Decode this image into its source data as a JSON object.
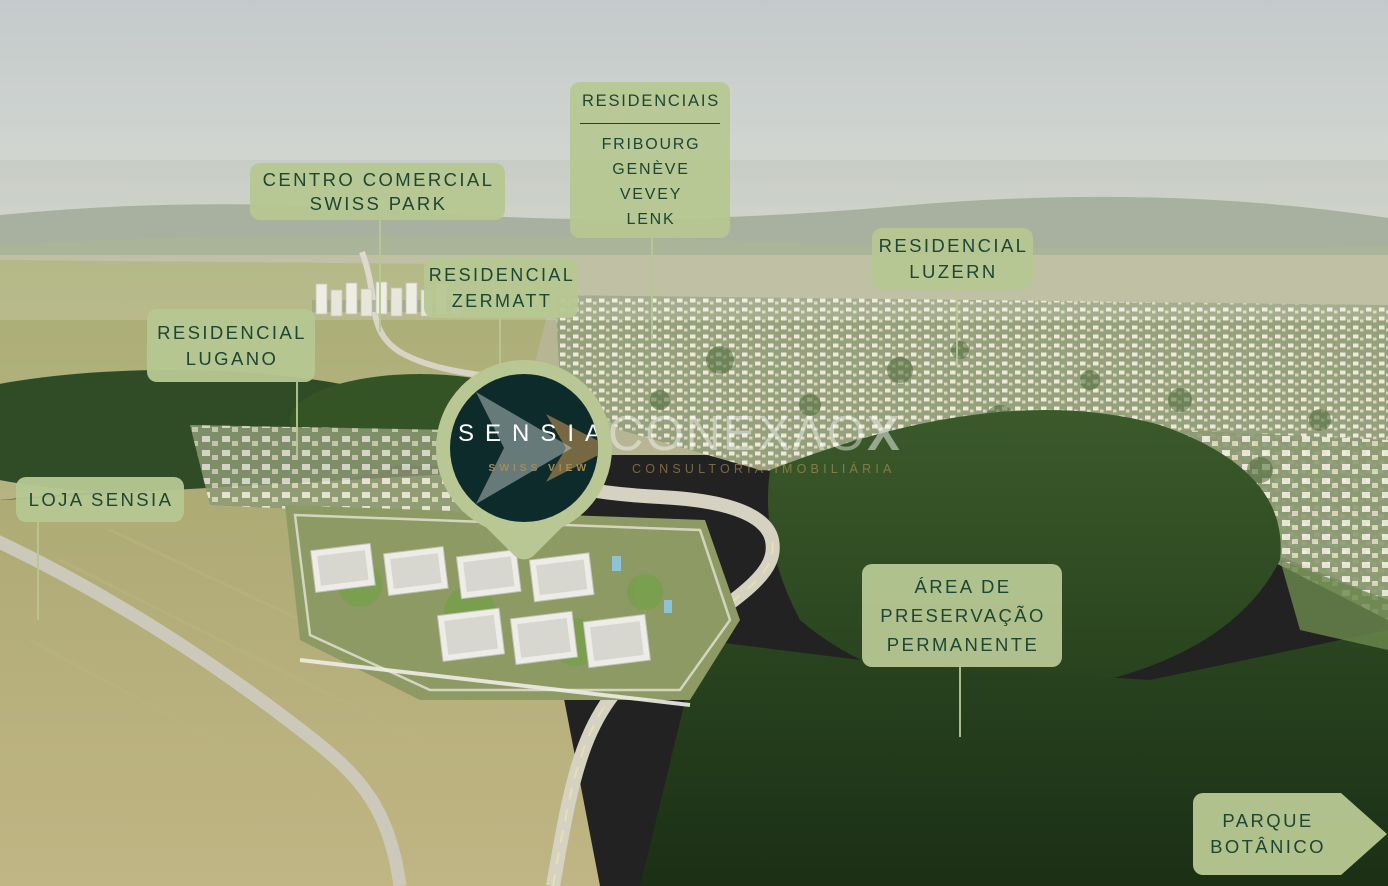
{
  "colors": {
    "label_background": "#b6c792",
    "label_text": "#1d4634",
    "pin_outer": "#b9c794",
    "pin_inner": "#0d2b2b",
    "logo_white": "#ffffff",
    "logo_gold": "#a38a58",
    "watermark_white": "#ffffff",
    "watermark_gold": "#ba9458"
  },
  "pin": {
    "brand": "SENSIA",
    "sub_brand": "SWISS VIEW"
  },
  "watermark": {
    "brand_light": "CONEXΛO",
    "brand_bold": "X",
    "tagline": "CONSULTORIA IMOBILIÁRIA"
  },
  "callouts": [
    {
      "id": "residenciais",
      "title": "RESIDENCIAIS",
      "lines": [
        "FRIBOURG",
        "GENÈVE",
        "VEVEY",
        "LENK"
      ]
    },
    {
      "id": "centro-comercial-swiss-park",
      "lines": [
        "CENTRO COMERCIAL",
        "SWISS PARK"
      ]
    },
    {
      "id": "residencial-zermatt",
      "lines": [
        "RESIDENCIAL",
        "ZERMATT"
      ]
    },
    {
      "id": "residencial-luzern",
      "lines": [
        "RESIDENCIAL",
        "LUZERN"
      ]
    },
    {
      "id": "residencial-lugano",
      "lines": [
        "RESIDENCIAL",
        "LUGANO"
      ]
    },
    {
      "id": "loja-sensia",
      "lines": [
        "LOJA SENSIA"
      ]
    },
    {
      "id": "area-de-preservacao-permanente",
      "lines": [
        "ÁREA DE",
        "PRESERVAÇÃO",
        "PERMANENTE"
      ]
    },
    {
      "id": "parque-botanico",
      "lines": [
        "PARQUE",
        "BOTÂNICO"
      ]
    }
  ]
}
